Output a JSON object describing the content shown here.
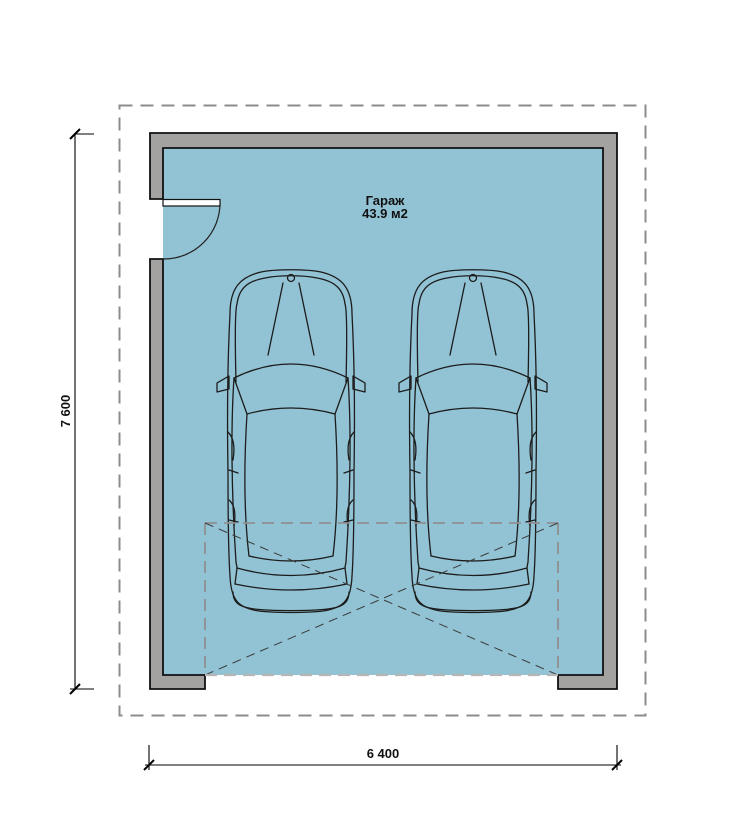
{
  "page": {
    "background": "#ffffff",
    "width": 744,
    "height": 837
  },
  "plan": {
    "room": {
      "label": "Гараж",
      "area": "43.9 м2"
    },
    "dimensions": {
      "vertical": "7 600",
      "horizontal": "6 400"
    },
    "colors": {
      "floor": "#92c3d4",
      "wall": "#a4a1a1",
      "wall_outline": "#111111",
      "roof_dash": "#8c8c8c",
      "opening_dash": "#b6b6b6",
      "cross_dash": "#3a3a3a",
      "car_line": "#1c1c1c",
      "dimension_line": "#000000"
    },
    "elements": {
      "cars": [
        "car-left",
        "car-right"
      ],
      "door": "swing-door-left-wall",
      "garage_opening": "dashed-cross-marking-bottom"
    }
  }
}
